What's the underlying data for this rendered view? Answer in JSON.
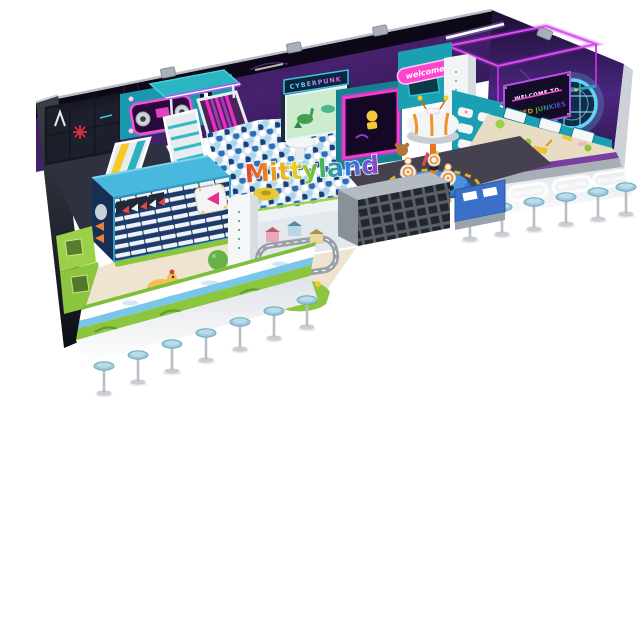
{
  "scene": {
    "description": "3D product render of an L-shaped cyberpunk-themed indoor soft playground on a white background",
    "background_color": "#ffffff"
  },
  "watermark": {
    "text": "Mittyland"
  },
  "signs": {
    "cyberpunk_marquee": "CYBERPUNK",
    "welcome_banner": "welcome",
    "welcome_to": "WELCOME TO",
    "speed_junkies": "SPEED JUNKIES",
    "bar_table_labels": [
      "WELCOME",
      "WELCOME",
      "WELCOME",
      "WELCOME"
    ]
  },
  "zones": {
    "left_cage": "black frame climbing cage",
    "wave_slide": "pink LED wave slide with teal canopy",
    "ball_pit": "white and blue ball pit with mushroom table and donut float",
    "interactive_screen": "dinosaur projection game wall",
    "arcade_screen": "magenta neon framed screen box",
    "carousel": "UFO dome robot carousel",
    "toddler_town": "green toddler soft play town with ride-on toys",
    "sand_pit": "space sand pit with toy diggers",
    "bar_counter": "glowing welcome bar tables with blue stools"
  },
  "counts": {
    "front_stools": 7,
    "right_stools": 6,
    "bar_tables": 4
  },
  "palette": {
    "wall_purple": "#3a1b5e",
    "neon_magenta": "#ff3fd8",
    "neon_cyan": "#41e7f2",
    "teal_structure": "#1fa9b8",
    "sky_blue_roof": "#49b8de",
    "lime_green": "#8dc63f",
    "cream_floor": "#efe4d0",
    "slide_pink": "#e92cc8",
    "stool_blue": "#9fc9da",
    "ball_blue": "#2e6fb8",
    "sand_beige": "#e9dcc4",
    "hazard_yellow": "#e8c020",
    "carousel_orange": "#f0922f"
  }
}
